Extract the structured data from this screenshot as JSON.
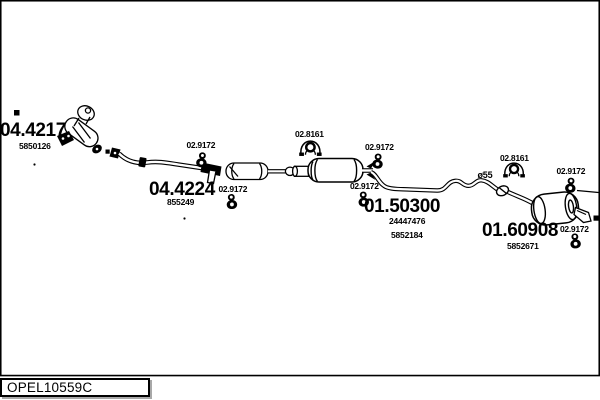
{
  "colors": {
    "background": "#ffffff",
    "line": "#000000"
  },
  "diagram": {
    "type": "exhaust-system-parts-diagram",
    "footer": {
      "drawing_code": "OPEL10559C"
    },
    "shared_labels": {
      "hanger_code": "02.9172",
      "bracket_code": "02.8161",
      "pipe_diameter": "ø55"
    },
    "parts": {
      "catalyst": {
        "code": "04.4217",
        "oe_number": "5850126"
      },
      "front_pipe": {
        "code": "04.4224",
        "oe_number": "855249"
      },
      "center_muffler": {
        "code": "01.50300",
        "oe_number_1": "24447476",
        "oe_number_2": "5852184"
      },
      "rear_muffler": {
        "code": "01.60908",
        "oe_number": "5852671"
      }
    },
    "icons": {
      "hanger": "rubber-hanger-icon",
      "bracket": "clamp-bracket-icon",
      "marker": "reference-square-marker"
    }
  }
}
